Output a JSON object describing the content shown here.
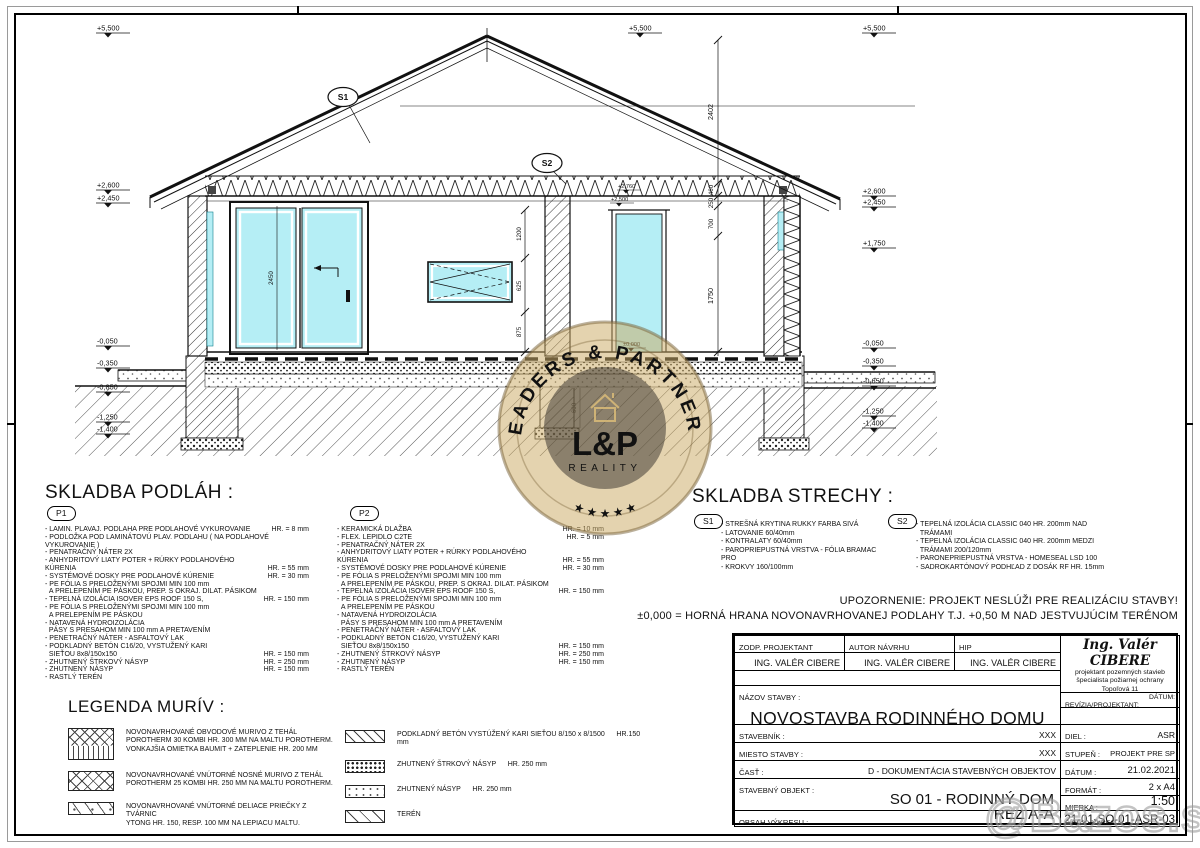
{
  "colors": {
    "glass": "#b5eef5",
    "seal_gold": "#c9a667",
    "line": "#111111"
  },
  "watermark": {
    "seal_top": "LEADERS & PARTNERS",
    "seal_main": "L&P",
    "seal_sub": "REALITY",
    "seal_stars": "★  ★  ★  ★  ★",
    "corner": "@Bazos.sk"
  },
  "drawing": {
    "bubbles": {
      "s1": "S1",
      "s2": "S2"
    },
    "elev_left": [
      "+5,500",
      "+2,600",
      "+2,450",
      "-0,050",
      "-0,350",
      "-0,850",
      "-1,250",
      "-1,400"
    ],
    "elev_right": [
      "+5,500",
      "+2,600",
      "+2,450",
      "+1,750",
      "-0,050",
      "-0,350",
      "-0,650",
      "-1,250",
      "-1,400"
    ],
    "elev_top": "+5,500",
    "interior_levels": [
      "+2,760",
      "+2,500",
      "±0,000"
    ],
    "dim_chain_main": [
      "2402",
      "460",
      "250",
      "700",
      "1750"
    ],
    "dim_chain_wall": [
      "1200",
      "625",
      "875"
    ],
    "dim_door": "2450",
    "dim_footing": "600"
  },
  "floors": {
    "title": "SKLADBA PODLÁH :",
    "p1": {
      "label": "P1",
      "items": [
        {
          "text": "- LAMIN. PLAVAJ. PODLAHA PRE PODLAHOVÉ VYKUROVANIE",
          "hr": "HR. = 8 mm"
        },
        {
          "text": "- PODLOŽKA POD LAMINÁTOVÚ PLAV. PODLAHU ( NA PODLAHOVÉ VYKUROVANIE )",
          "hr": ""
        },
        {
          "text": "- PENATRAČNÝ NÁTER 2X",
          "hr": ""
        },
        {
          "text": "- ANHYDRITOVÝ LIATY POTER + RÚRKY PODLAHOVÉHO KÚRENIA",
          "hr": "HR. = 55 mm"
        },
        {
          "text": "- SYSTÉMOVÉ DOSKY PRE PODLAHOVÉ KÚRENIE",
          "hr": "HR. = 30 mm"
        },
        {
          "text": "- PE FÓLIA S PRELOŽENÝMI SPOJMI MIN 100 mm\n  A PRELEPENÍM PE PÁSKOU, PREP. S OKRAJ. DILAT. PÁSIKOM",
          "hr": ""
        },
        {
          "text": "- TEPELNÁ IZOLÁCIA ISOVER EPS ROOF 150 S,",
          "hr": "HR. = 150 mm"
        },
        {
          "text": "- PE FÓLIA S PRELOŽENÝMI SPOJMI MIN 100 mm\n  A PRELEPENÍM PE PÁSKOU",
          "hr": ""
        },
        {
          "text": "- NATAVENÁ HYDROIZOLÁCIA\n  PÁSY S PRESAHOM MIN 100 mm A PRETAVENÍM",
          "hr": ""
        },
        {
          "text": "- PENETRAČNÝ NÁTER - ASFALTOVÝ LAK",
          "hr": ""
        },
        {
          "text": "- PODKLADNÝ BETÓN C16/20, VYSTUŽENÝ KARI\n  SIEŤOU 8x8/150x150",
          "hr": "HR. = 150 mm"
        },
        {
          "text": "- ZHUTNENÝ ŠTRKOVÝ NÁSYP",
          "hr": "HR. = 250 mm"
        },
        {
          "text": "- ZHUTNENÝ NÁSYP",
          "hr": "HR. = 150 mm"
        },
        {
          "text": "- RASTLÝ TERÉN",
          "hr": ""
        }
      ]
    },
    "p2": {
      "label": "P2",
      "items": [
        {
          "text": "- KERAMICKÁ DLAŽBA",
          "hr": "HR. = 10 mm"
        },
        {
          "text": "- FLEX. LEPIDLO C2TE",
          "hr": "HR. = 5 mm"
        },
        {
          "text": "- PENATRAČNÝ NÁTER 2X",
          "hr": ""
        },
        {
          "text": "- ANHYDRITOVÝ LIATY POTER + RÚRKY PODLAHOVÉHO KÚRENIA",
          "hr": "HR. = 55 mm"
        },
        {
          "text": "- SYSTÉMOVÉ DOSKY PRE PODLAHOVÉ KÚRENIE",
          "hr": "HR. = 30 mm"
        },
        {
          "text": "- PE FÓLIA S PRELOŽENÝMI SPOJMI MIN 100 mm\n  A PRELEPENÍM PE PÁSKOU, PREP. S OKRAJ. DILAT. PÁSIKOM",
          "hr": ""
        },
        {
          "text": "- TEPELNÁ IZOLÁCIA ISOVER EPS ROOF 150 S,",
          "hr": "HR. = 150 mm"
        },
        {
          "text": "- PE FÓLIA S PRELOŽENÝMI SPOJMI MIN 100 mm\n  A PRELEPENÍM PE PÁSKOU",
          "hr": ""
        },
        {
          "text": "- NATAVENÁ HYDROIZOLÁCIA\n  PÁSY S PRESAHOM MIN 100 mm A PRETAVENÍM",
          "hr": ""
        },
        {
          "text": "- PENETRAČNÝ NÁTER - ASFALTOVÝ LAK",
          "hr": ""
        },
        {
          "text": "- PODKLADNÝ BETÓN C16/20, VYSTUŽENÝ KARI\n  SIEŤOU 8x8/150x150",
          "hr": "HR. = 150 mm"
        },
        {
          "text": "- ZHUTNENÝ ŠTRKOVÝ NÁSYP",
          "hr": "HR. = 250 mm"
        },
        {
          "text": "- ZHUTNENÝ NÁSYP",
          "hr": "HR. = 150 mm"
        },
        {
          "text": "- RASTLÝ TERÉN",
          "hr": ""
        }
      ]
    }
  },
  "roof": {
    "title": "SKLADBA STRECHY :",
    "s1": {
      "label": "S1",
      "items": [
        "- STREŠNÁ KRYTINA RUKKY FARBA SIVÁ",
        "- LATOVANIE 60/40mm",
        "- KONTRALATY 60/40mm",
        "- PAROPRIEPUSTNÁ VRSTVA - FÓLIA BRAMAC PRO",
        "- KROKVY 160/100mm"
      ]
    },
    "s2": {
      "label": "S2",
      "items": [
        "- TEPELNÁ IZOLÁCIA CLASSIC 040 HR. 200mm NAD\n  TRÁMAMI",
        "- TEPELNÁ IZOLÁCIA CLASSIC 040 HR. 200mm MEDZI\n  TRÁMAMI 200/120mm",
        "- PARONEPRIEPUSTNÁ VRSTVA - HOMESEAL LSD 100",
        "- SADROKARTÓNOVÝ PODHĽAD Z DOSÁK RF HR. 15mm"
      ]
    }
  },
  "notes": {
    "warning": "UPOZORNENIE: PROJEKT NESLÚŽI PRE REALIZÁCIU STAVBY!",
    "zero_level": "±0,000 = HORNÁ HRANA NOVONAVRHOVANEJ PODLAHY T.J. +0,50 M NAD JESTVUJÚCIM TERÉNOM"
  },
  "legend": {
    "title": "LEGENDA MURÍV :",
    "left": [
      {
        "swatch_class": "sw pat-peri",
        "text": "NOVONAVRHOVANÉ OBVODOVÉ MURIVO Z TEHÁL\nPOROTHERM 30 KOMBI HR. 300 MM NA MALTU POROTHERM.\nVONKAJŠIA OMIETKA BAUMIT + ZATEPLENIE HR. 200 MM"
      },
      {
        "swatch_class": "sw pat-cross",
        "text": "NOVONAVRHOVANÉ VNÚTORNÉ NOSNÉ MURIVO Z TEHÁL\nPOROTHERM 25 KOMBI HR. 250 MM NA MALTU POROTHERM."
      },
      {
        "swatch_class": "sw pat-ytong",
        "text": "NOVONAVRHOVANÉ VNÚTORNÉ DELIACE PRIEČKY Z TVÁRNIC\nYTONG HR. 150, RESP. 100 MM NA LEPIACU MALTU."
      }
    ],
    "right": [
      {
        "swatch_class": "sw pat-diag",
        "text": "PODKLADNÝ BETÓN VYSTÚŽENÝ KARI SIEŤOU 8/150 x 8/1500      HR.150 mm"
      },
      {
        "swatch_class": "sw pat-gravel",
        "text": "ZHUTNENÝ ŠTRKOVÝ NÁSYP      HR. 250 mm"
      },
      {
        "swatch_class": "sw pat-sand",
        "text": "ZHUTNENÝ NÁSYP      HR. 250 mm"
      },
      {
        "swatch_class": "sw pat-terrain",
        "text": "TERÉN"
      }
    ]
  },
  "titleblock": {
    "zodp_label": "ZODP. PROJEKTANT",
    "autor_label": "AUTOR NÁVRHU",
    "hip_label": "HIP",
    "zodp_name": "ING. VALÉR CIBERE",
    "autor_name": "ING. VALÉR CIBERE",
    "hip_name": "ING. VALÉR CIBERE",
    "nazov_label": "NÁZOV STAVBY :",
    "nazov_value": "NOVOSTAVBA RODINNÉHO DOMU",
    "stavebnik_label": "STAVEBNÍK :",
    "stavebnik_value": "XXX",
    "miesto_label": "MIESTO STAVBY :",
    "miesto_value": "XXX",
    "cast_label": "ČASŤ :",
    "cast_value": "D - DOKUMENTÁCIA STAVEBNÝCH OBJEKTOV",
    "objekt_label": "STAVEBNÝ OBJEKT :",
    "objekt_value": "SO 01 - RODINNÝ DOM",
    "obsah_label": "OBSAH VÝKRESU :",
    "obsah_value": "REZ A-A",
    "stamp": {
      "name": "Ing. Valér CIBERE",
      "line1": "projektant pozemných stavieb",
      "line2": "špecialista požiarnej ochrany",
      "line3": "Topoľová 11",
      "line4": "Michalovce 071 01",
      "line5": "mobil : 0905 438 105"
    },
    "revizia_label": "REVÍZIA/PROJEKTANT:",
    "revizia_datum": "DÁTUM:",
    "diel_label": "DIEL :",
    "diel_value": "ASR",
    "stupen_label": "STUPEŇ :",
    "stupen_value": "PROJEKT PRE SP",
    "datum_label": "DÁTUM :",
    "datum_value": "21.02.2021",
    "format_label": "FORMÁT :",
    "format_value": "2 x A4",
    "mierka_label": "MIERKA :",
    "mierka_value": "1:50",
    "cislo_label": "ČÍSLO VÝKRESU :",
    "cislo_value": "21-01-SO-01-ASR-03"
  }
}
